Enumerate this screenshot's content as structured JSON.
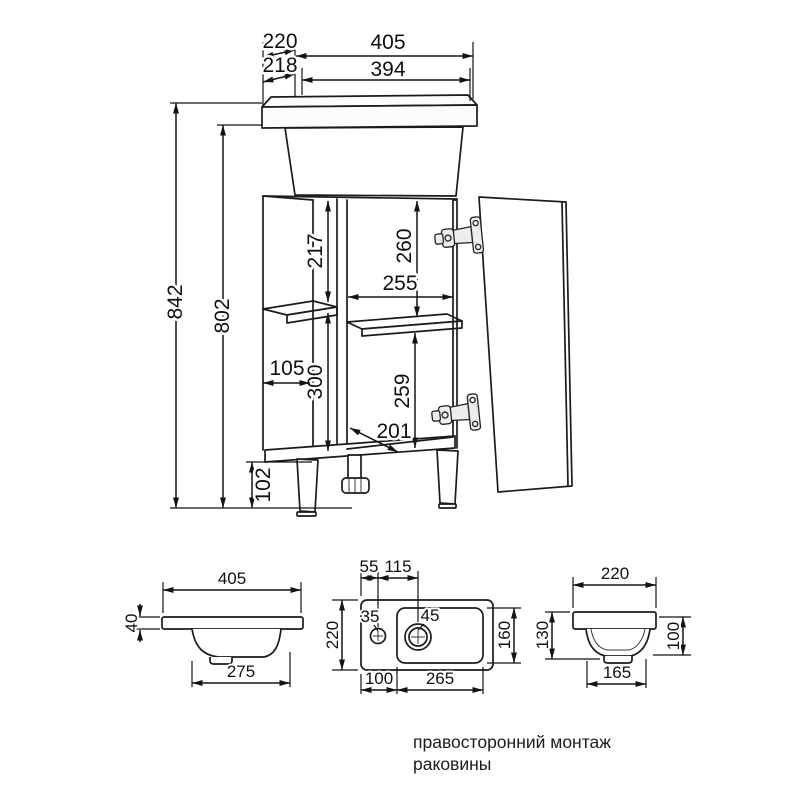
{
  "main_view": {
    "overall_width": "405",
    "basin_width": "394",
    "overall_depth": "220",
    "basin_depth": "218",
    "total_height": "842",
    "cabinet_height": "802",
    "leg_height": "102",
    "upper_section_height": "217",
    "upper_opening_height": "260",
    "opening_width": "255",
    "side_shelf_depth": "105",
    "lower_section_height": "300",
    "lower_opening_height": "259",
    "opening_depth": "201"
  },
  "front_view": {
    "width": "405",
    "rim_height": "40",
    "bowl_width": "275"
  },
  "top_view": {
    "faucet_offset": "55",
    "drain_offset": "115",
    "depth": "220",
    "faucet_hole": "35",
    "drain_hole": "45",
    "bowl_depth": "160",
    "left_offset": "100",
    "bowl_width": "265"
  },
  "side_view": {
    "depth": "220",
    "height": "130",
    "bowl_height": "100",
    "bowl_depth": "165"
  },
  "caption": {
    "line1": "правосторонний монтаж",
    "line2": "раковины"
  }
}
